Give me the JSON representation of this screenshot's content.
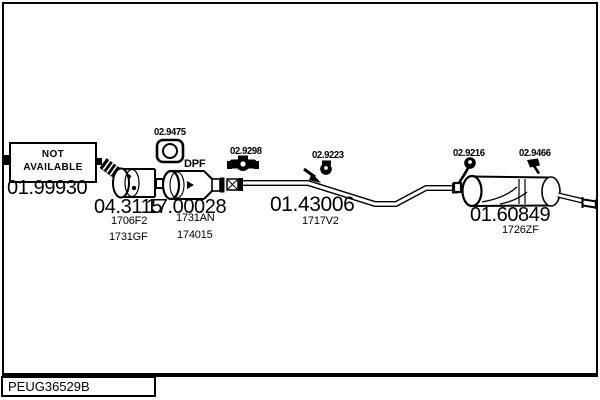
{
  "frame": {
    "code_label": "PEUG36529B"
  },
  "colors": {
    "ink": "#000000",
    "paper": "#ffffff"
  },
  "not_available": {
    "line1": "NOT",
    "line2": "AVAILABLE"
  },
  "parts": {
    "front_section": {
      "number": "01.99930"
    },
    "flex_cat": {
      "number": "04.3115",
      "refs": [
        "1706F2",
        "1731GF"
      ]
    },
    "dpf": {
      "number": "17.00028",
      "refs": [
        "1731AN",
        "174015"
      ],
      "tag": "DPF"
    },
    "mid_pipe": {
      "number": "01.43006",
      "refs": [
        "1717V2"
      ]
    },
    "rear_muffler": {
      "number": "01.60849",
      "refs": [
        "1726ZF"
      ]
    }
  },
  "fittings": {
    "clamp_square": {
      "number": "02.9475"
    },
    "clamp_bolted": {
      "number": "02.9298"
    },
    "hanger_mid": {
      "number": "02.9223"
    },
    "hanger_rear": {
      "number": "02.9216"
    },
    "hook_tail": {
      "number": "02.9466"
    }
  }
}
